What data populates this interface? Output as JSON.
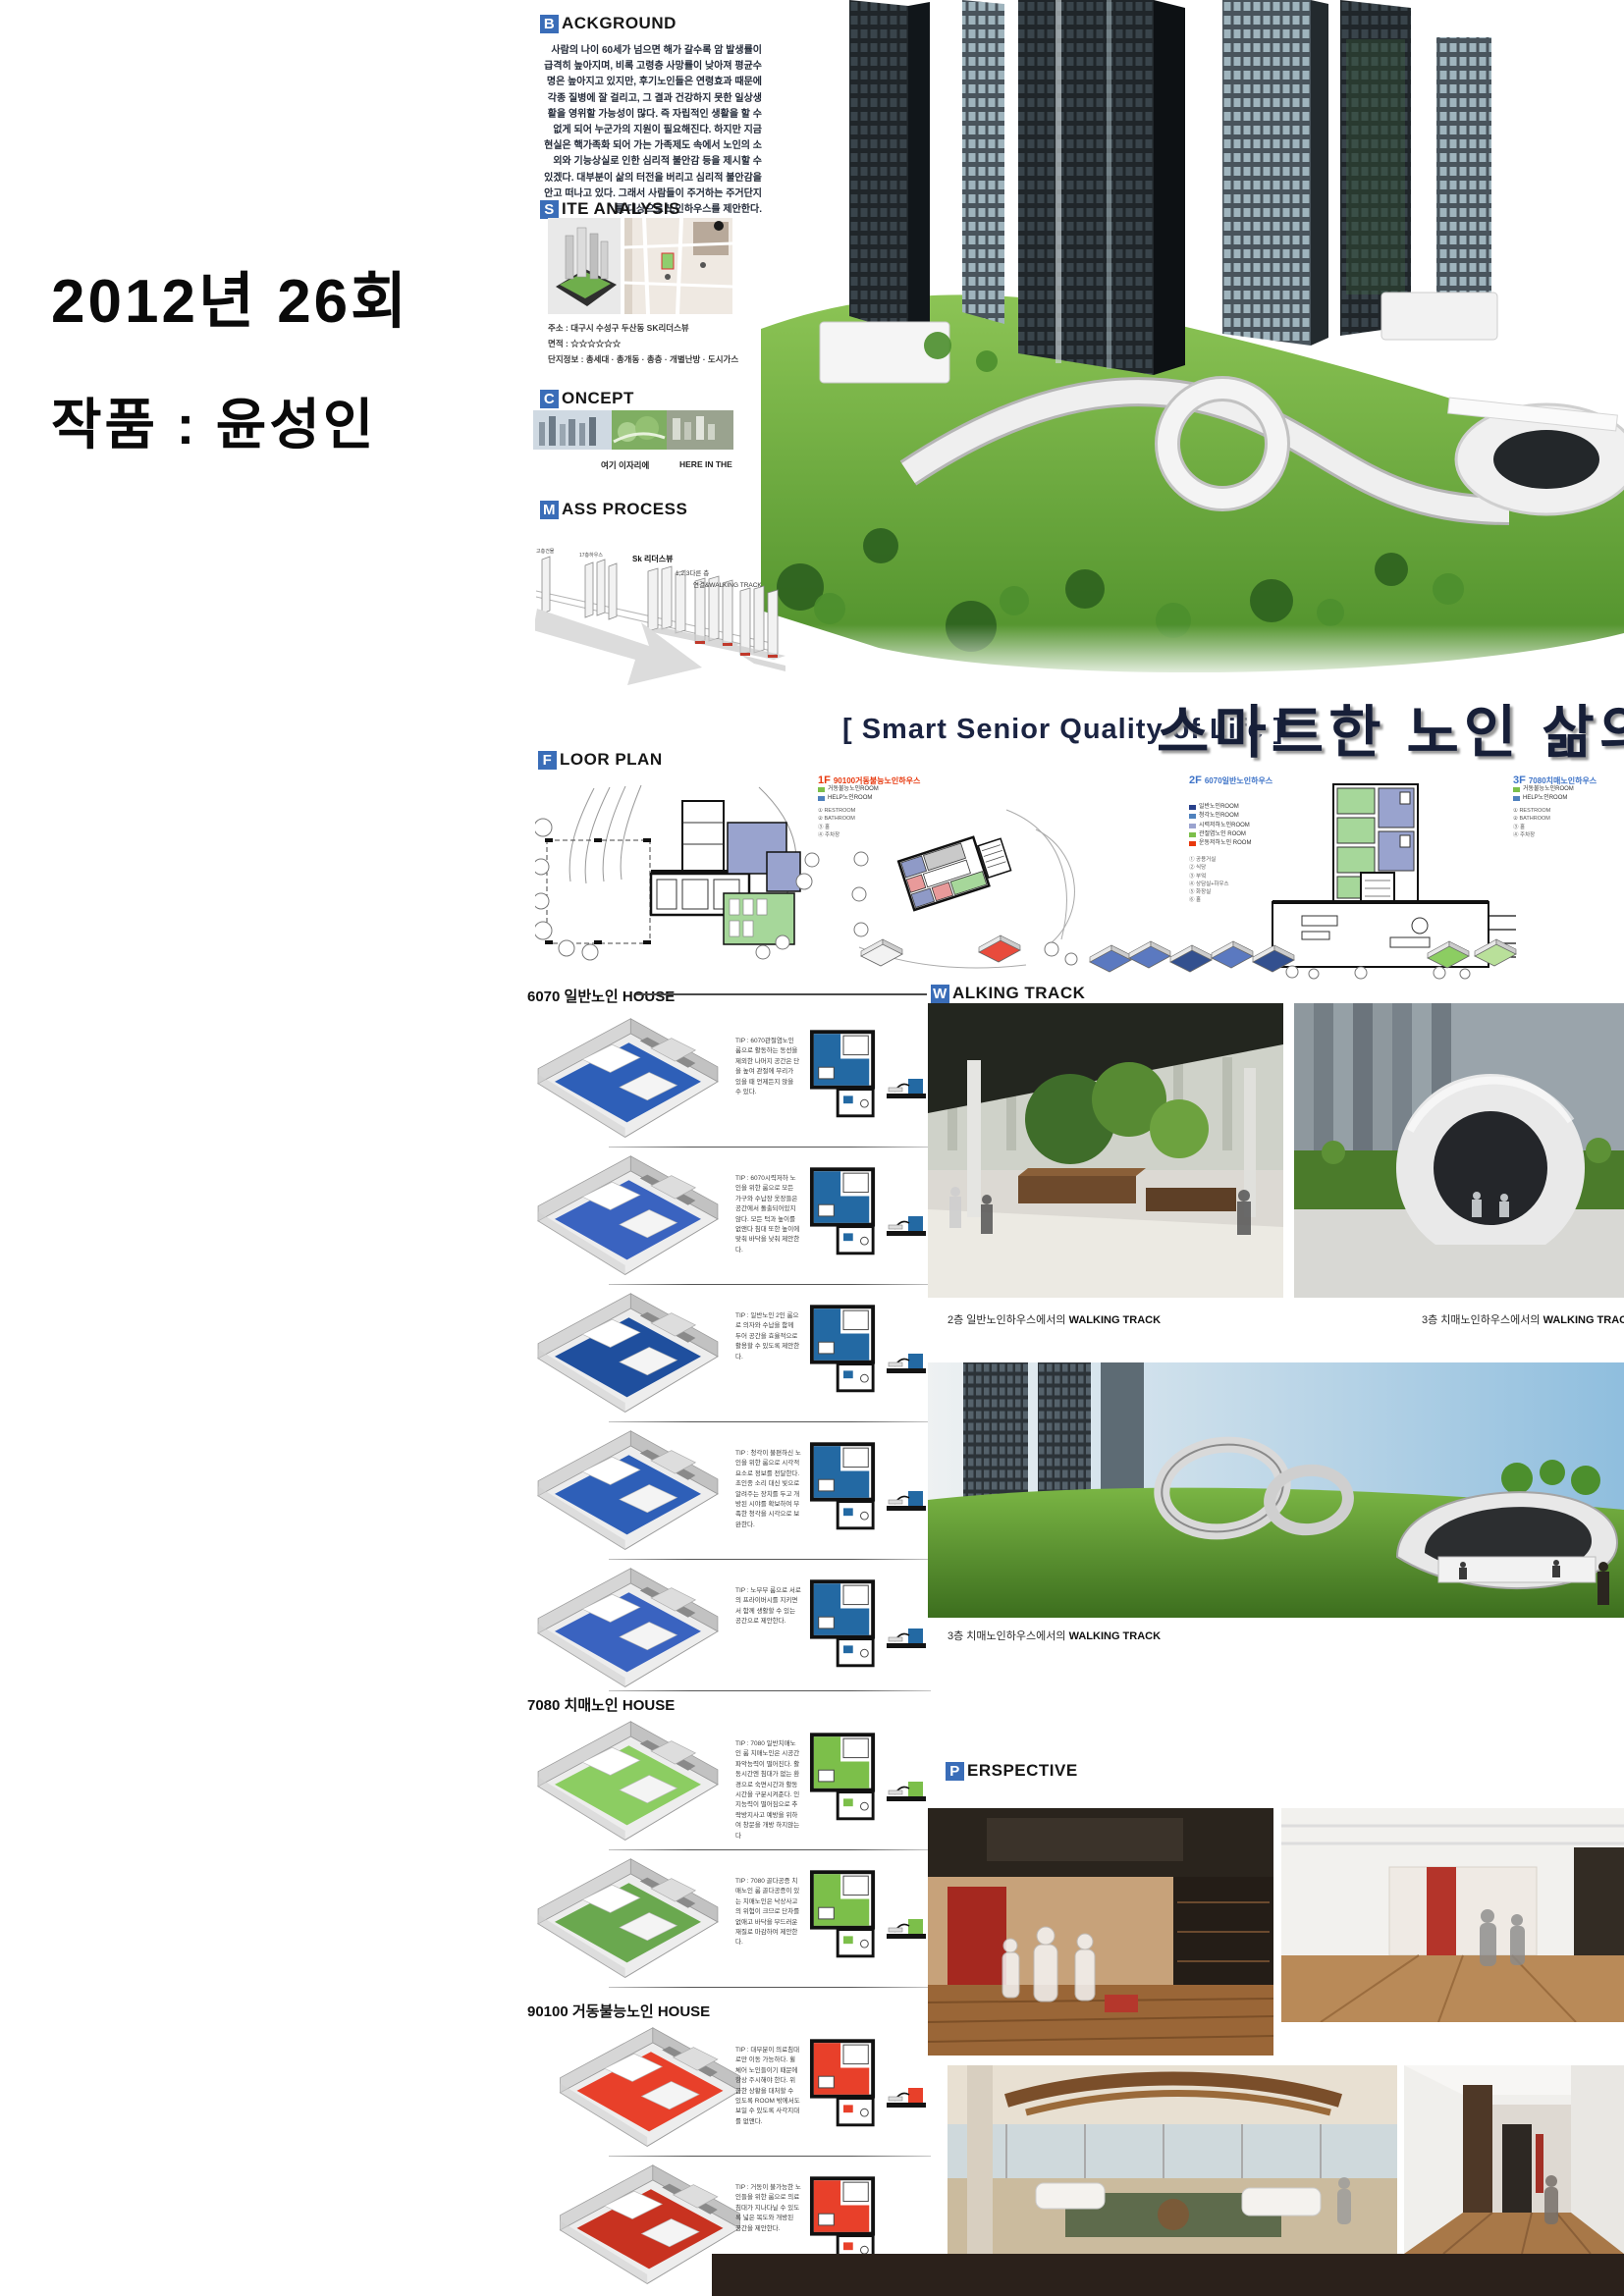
{
  "left_panel": {
    "line1": "2012년 26회",
    "line2": "작품 : 윤성인"
  },
  "headers": {
    "background": {
      "i": "B",
      "t": "ACKGROUND"
    },
    "site": {
      "i": "S",
      "t": "ITE ANALYSIS"
    },
    "concept": {
      "i": "C",
      "t": "ONCEPT"
    },
    "mass": {
      "i": "M",
      "t": "ASS PROCESS"
    },
    "floor": {
      "i": "F",
      "t": "LOOR PLAN"
    },
    "walking": {
      "i": "W",
      "t": "ALKING TRACK"
    },
    "perspective": {
      "i": "P",
      "t": "ERSPECTIVE"
    }
  },
  "background": {
    "body": "사람의 나이 60세가 넘으면 해가 갈수록 암 발생률이 급격히 높아지며, 비록 고령층 사망률이 낮아져 평균수명은 높아지고 있지만, 후기노인들은 연령효과 때문에 각종 질병에 잘 걸리고, 그 결과 건강하지 못한 일상생활을 영위할 가능성이 많다. 즉 자립적인 생활을 할 수 없게 되어 누군가의 지원이 필요해진다. 하지만 지금 현실은 핵가족화 되어 가는 가족제도 속에서 노인의 소외와 기능상실로 인한 심리적 불안감 등을 제시할 수 있겠다. 대부분이 삶의 터전을 버리고 심리적 불안감을 안고 떠나고 있다. 그래서 사람들이 주거하는 주거단지를 대상으로 노인하우스를 제안한다."
  },
  "site": {
    "addr": "주소 : 대구시 수성구 두산동 SK리더스뷰",
    "area": "면적 : ☆☆☆☆☆☆",
    "info": "단지정보 : 총세대 · 총개동 · 총층 · 개별난방 · 도시가스"
  },
  "concept": {
    "ko": "여기 이자리에",
    "en": "HERE IN THE"
  },
  "mass": {
    "labels": [
      "고층건물",
      "17층하우스",
      "Sk 리더스뷰",
      "1,2,3다른 층",
      "연결&WALKING TRACK"
    ]
  },
  "title": {
    "en": "[ Smart Senior Quality of Life ]",
    "ko": "스마트한 노인 삶의 질"
  },
  "accent_colors": {
    "header_blue": "#3a6db8",
    "title_navy": "#171f38",
    "label_red": "#e8380d",
    "label_blue": "#3f74c8",
    "room_green": "#a6d79a",
    "room_purple": "#99a3ce",
    "unit_blue": "#2e5fb8",
    "unit_green": "#8ccd62",
    "unit_red": "#e8402a"
  },
  "floorplans": {
    "p1": {
      "floor": "1F",
      "name": "90100거동불능노인하우스",
      "legend": [
        {
          "c": "#7cbf4a",
          "t": "거동불능노인ROOM"
        },
        {
          "c": "#4f81bd",
          "t": "HELP노인ROOM"
        }
      ],
      "notes": [
        "① RESTROOM",
        "② BATHROOM",
        "③ 홀",
        "④ 주차장"
      ]
    },
    "p2": {
      "floor": "2F",
      "name": "6070일반노인하우스",
      "legend": [
        {
          "c": "#27408b",
          "t": "일반노인ROOM"
        },
        {
          "c": "#4f81bd",
          "t": "청각노인ROOM"
        },
        {
          "c": "#9aa3cf",
          "t": "시력저하노인ROOM"
        },
        {
          "c": "#7cbf4a",
          "t": "관절염노인 ROOM"
        },
        {
          "c": "#e8380d",
          "t": "운동저하노인 ROOM"
        }
      ],
      "notes": [
        "① 공용거실",
        "② 식당",
        "③ 부엌",
        "④ 상담실+하우스",
        "⑤ 화장실",
        "⑥ 홀"
      ]
    },
    "p3": {
      "floor": "3F",
      "name": "7080치매노인하우스",
      "legend": [
        {
          "c": "#7cbf4a",
          "t": "거동불능노인ROOM"
        },
        {
          "c": "#4f81bd",
          "t": "HELP노인ROOM"
        }
      ],
      "notes": [
        "① RESTROOM",
        "② BATHROOM",
        "③ 홀",
        "④ 주차장"
      ]
    }
  },
  "units": {
    "s6070": {
      "title": "6070 일반노인 HOUSE",
      "rows": [
        {
          "tip": "TIP : 6070관절염노인 룸으로 활동하는 동선을 제외한 나머지 공간은 단을 높여 관절에 무리가 있을 때 언제든지 앉을 수 있다."
        },
        {
          "tip": "TIP : 6070시력저하 노인을 위한 룸으로 모든 가구와 수납장 옷장들은 공간에서 돌출되어있지 않다. 모든 턱과 높이를 없앤다 침대 또한 높이에 맞춰 바닥을 낮춰 제안한다."
        },
        {
          "tip": "TIP : 일반노인 2인 룸으로 의자와 수납을 함께 두어 공간을 효율적으로 활용할 수 있도록 제안한다."
        },
        {
          "tip": "TIP : 청각이 불편하신 노인을 위한 룸으로 시각적 요소로 정보를 전달한다. 초인종 소리 대신 빛으로 알려주는 장치를 두고 개방된 시야를 확보하여 부족한 청각을 시각으로 보완한다."
        },
        {
          "tip": "TIP : 노부부 룸으로 서로의 프라이버시를 지키면서 함께 생활할 수 있는 공간으로 제안한다."
        }
      ]
    },
    "s7080": {
      "title": "7080 치매노인 HOUSE",
      "rows": [
        {
          "tip": "TIP : 7080 일반치매노인 룸 치매노인은 시공간 파악능력이 떨어진다. 활동시간엔 침대가 없는 환경으로 숙면시간과 활동시간을 구분시켜준다. 인지능력이 떨어짐으로 추락방지사고 예방을 위하여 창문을 개방 하지않는다"
        },
        {
          "tip": "TIP : 7080 골다공증 치매노인 룸 골다공증이 있는 치매노인은 낙상사고의 위험이 크므로 단차를 없애고 바닥을 부드러운 재질로 마감하여 제안한다."
        }
      ]
    },
    "s90100": {
      "title": "90100 거동불능노인 HOUSE",
      "rows": [
        {
          "tip": "TIP : 대부분이 의료침대로만 이동 가능하다. 휠체어 노인들이기 때문에 항상 주시해야 한다. 위급한 상황을 대처할 수 있도록 ROOM 밖에서도 보일 수 있도록 사각지대를 없앤다."
        },
        {
          "tip": "TIP : 거동이 불가능한 노인들을 위한 룸으로 의료침대가 지나다닐 수 있도록 넓은 복도와 개방된 공간을 제안한다."
        }
      ]
    }
  },
  "walking": {
    "cap1_pre": "2층 일반노인하우스에서의",
    "cap1_bold": "WALKING TRACK",
    "cap2_pre": "3층 치매노인하우스에서의",
    "cap2_bold": "WALKING TRACK",
    "cap3_pre": "3층 치매노인하우스에서의",
    "cap3_bold": "WALKING TRACK"
  }
}
